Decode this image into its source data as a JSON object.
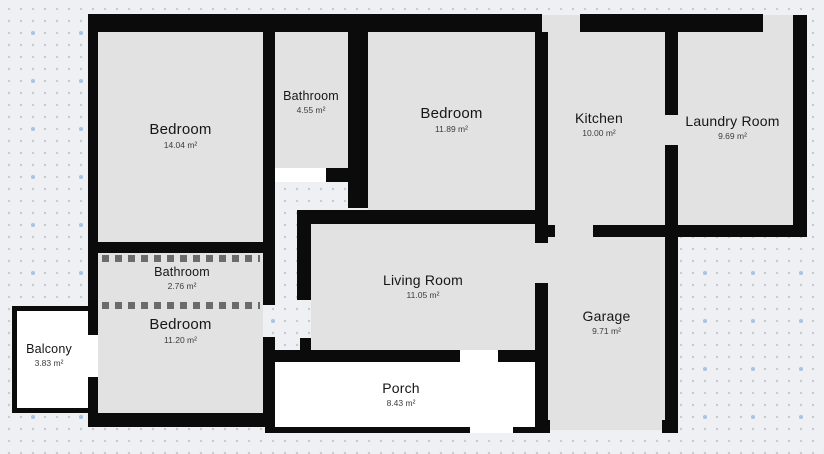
{
  "app": {
    "view_title": "Floor plan canvas"
  },
  "palette": {
    "wall": "#0b0b0b",
    "room-fill": "#e2e2e2",
    "outdoor-fill": "#ffffff",
    "dashed-wall": "#6b6b6b",
    "bg": "#eff0f3",
    "dot": "#c6cacf",
    "dot-accent": "#a9c4e2"
  },
  "rooms": [
    {
      "id": "bedroom-1",
      "name": "Bedroom",
      "area": "14.04 m²"
    },
    {
      "id": "bathroom-1",
      "name": "Bathroom",
      "area": "4.55 m²"
    },
    {
      "id": "bedroom-2",
      "name": "Bedroom",
      "area": "11.89 m²"
    },
    {
      "id": "kitchen",
      "name": "Kitchen",
      "area": "10.00 m²"
    },
    {
      "id": "laundry-room",
      "name": "Laundry Room",
      "area": "9.69 m²"
    },
    {
      "id": "bathroom-2",
      "name": "Bathroom",
      "area": "2.76 m²"
    },
    {
      "id": "bedroom-3",
      "name": "Bedroom",
      "area": "11.20 m²"
    },
    {
      "id": "living-room",
      "name": "Living Room",
      "area": "11.05 m²"
    },
    {
      "id": "garage",
      "name": "Garage",
      "area": "9.71 m²"
    },
    {
      "id": "balcony",
      "name": "Balcony",
      "area": "3.83 m²"
    },
    {
      "id": "porch",
      "name": "Porch",
      "area": "8.43 m²"
    }
  ]
}
